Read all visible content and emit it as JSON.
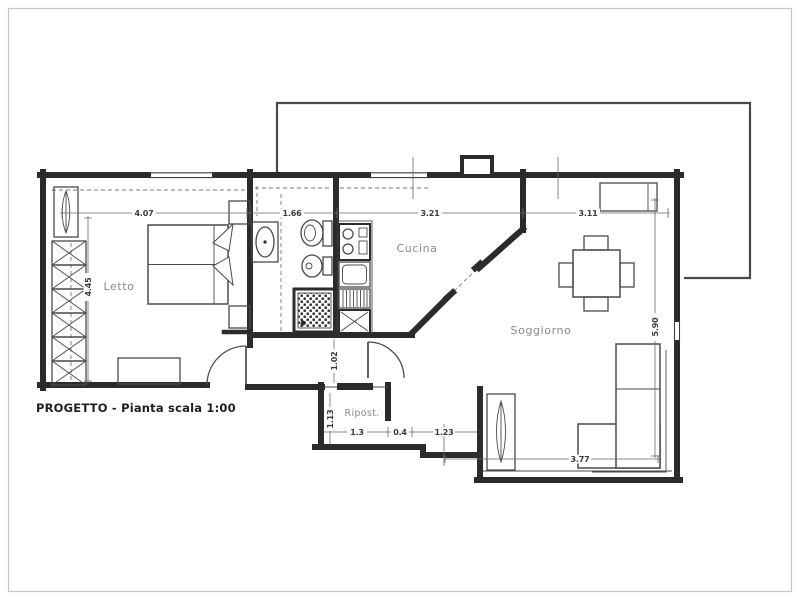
{
  "drawing": {
    "caption": "PROGETTO - Pianta scala 1:00"
  },
  "rooms": {
    "bedroom": "Letto",
    "kitchen": "Cucina",
    "living": "Soggiorno",
    "storage": "Ripost."
  },
  "dimensions": {
    "bedroom_width": "4.07",
    "bedroom_depth": "4.45",
    "bathroom_width": "1.66",
    "kitchen_width": "3.21",
    "living_width": "3.11",
    "living_depth": "5.90",
    "hallway_width": "1.02",
    "storage_depth": "1.13",
    "storage_width": "1.3",
    "wall_thickness": "0.4",
    "passage_width": "1.23",
    "sofa_wall_width": "3.77"
  },
  "colors": {
    "wall": "#2b2b2b",
    "line": "#4a4a4a",
    "dimension_text": "#3a3a3a",
    "room_label": "#8a8a8a",
    "paper": "#ffffff",
    "frame": "#c4c4c4"
  }
}
